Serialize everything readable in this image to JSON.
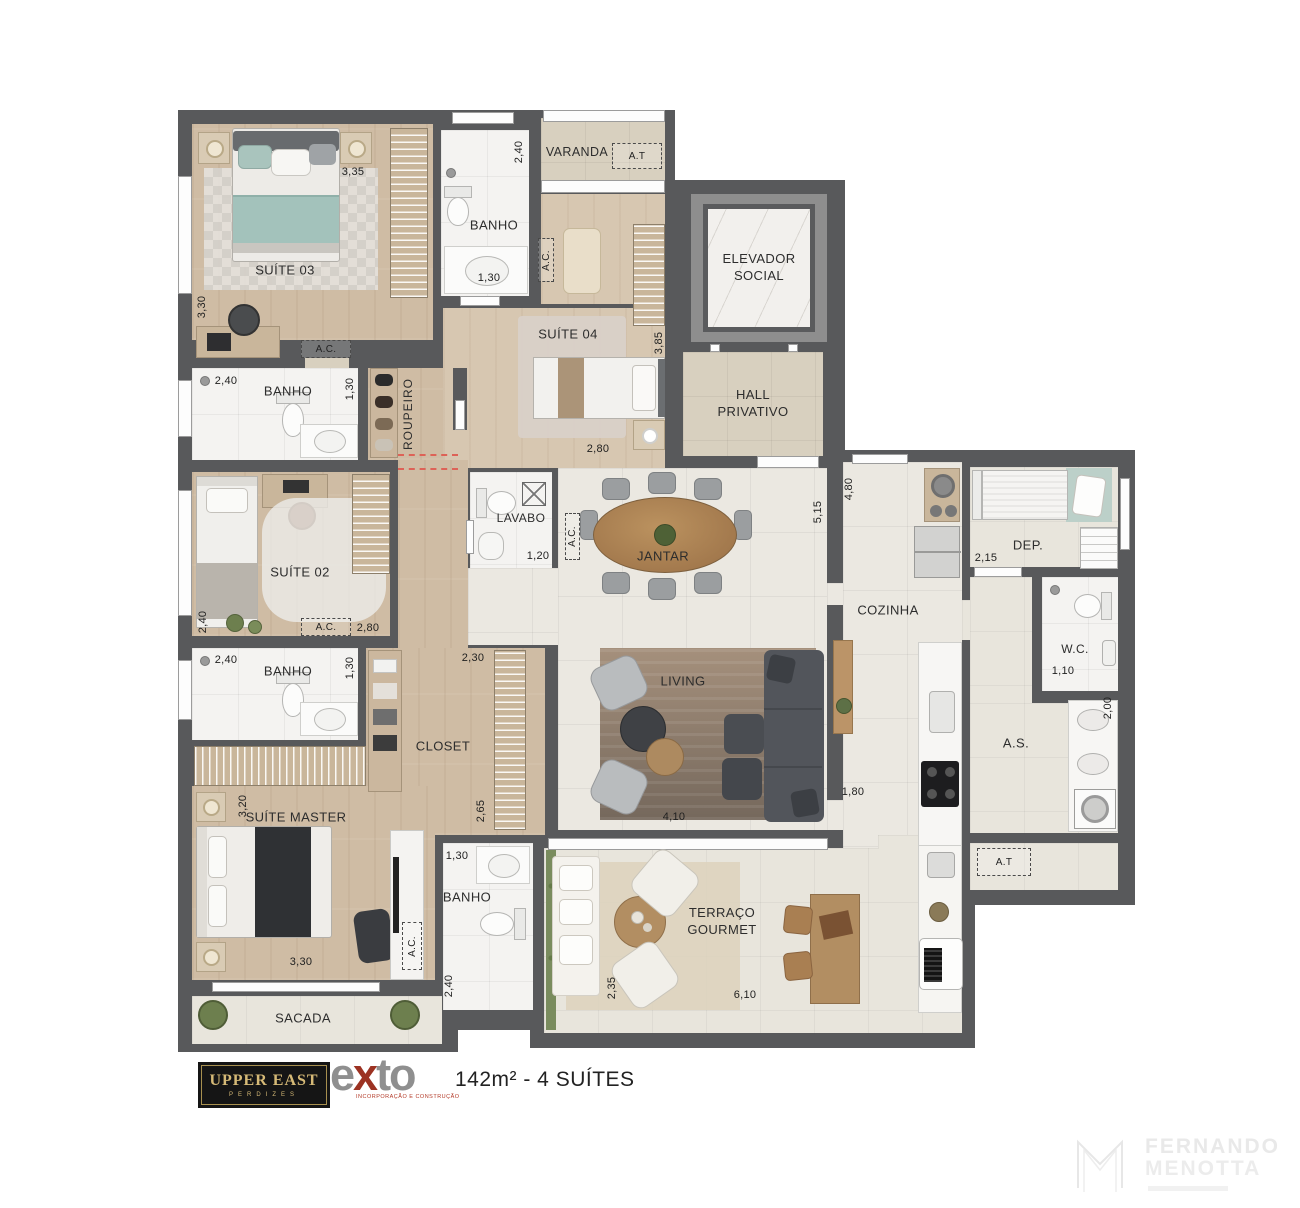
{
  "plan": {
    "labels": {
      "suite03": "SUÍTE 03",
      "banho": "BANHO",
      "varanda": "VARANDA",
      "at": "A.T",
      "ac": "A.C.",
      "suite04": "SUÍTE 04",
      "elevador": "ELEVADOR\nSOCIAL",
      "hall": "HALL\nPRIVATIVO",
      "roupeiro": "ROUPEIRO",
      "suite02": "SUÍTE 02",
      "lavabo": "LAVABO",
      "jantar": "JANTAR",
      "cozinha": "COZINHA",
      "dep": "DEP.",
      "wc": "W.C.",
      "as": "A.S.",
      "living": "LIVING",
      "closet": "CLOSET",
      "suite_master": "SUÍTE MASTER",
      "sacada": "SACADA",
      "terraco": "TERRAÇO\nGOURMET"
    },
    "dims": {
      "suite03_w": "3,35",
      "suite03_h": "3,30",
      "banho03_h": "2,40",
      "banho03_w": "1,30",
      "banho02_w": "2,40",
      "banho02_h": "1,30",
      "suite04_h": "3,85",
      "suite04_w": "2,80",
      "cozinha_h": "4,80",
      "jantar_h": "5,15",
      "dep_w": "2,15",
      "wc_w": "1,10",
      "as_h": "2,00",
      "lavabo_w": "1,20",
      "suite02_h": "2,40",
      "suite02_w": "2,80",
      "banho3_w": "2,40",
      "banho3_h": "1,30",
      "closet_w": "2,30",
      "closet_h": "2,65",
      "master_h": "3,20",
      "master_w": "3,30",
      "banhom_w": "1,30",
      "banhom_h": "2,40",
      "living_w": "4,10",
      "pass_w": "1,80",
      "terraco_h": "2,35",
      "terraco_w": "6,10"
    }
  },
  "footer": {
    "brand_line1": "UPPER EAST",
    "brand_line2": "PERDIZES",
    "exto_e": "e",
    "exto_x": "x",
    "exto_to": "to",
    "exto_sub": "INCORPORAÇÃO E CONSTRUÇÃO",
    "area": "142m² - 4 SUÍTES"
  },
  "watermark": {
    "line1": "FERNANDO",
    "line2": "MENOTTA"
  }
}
